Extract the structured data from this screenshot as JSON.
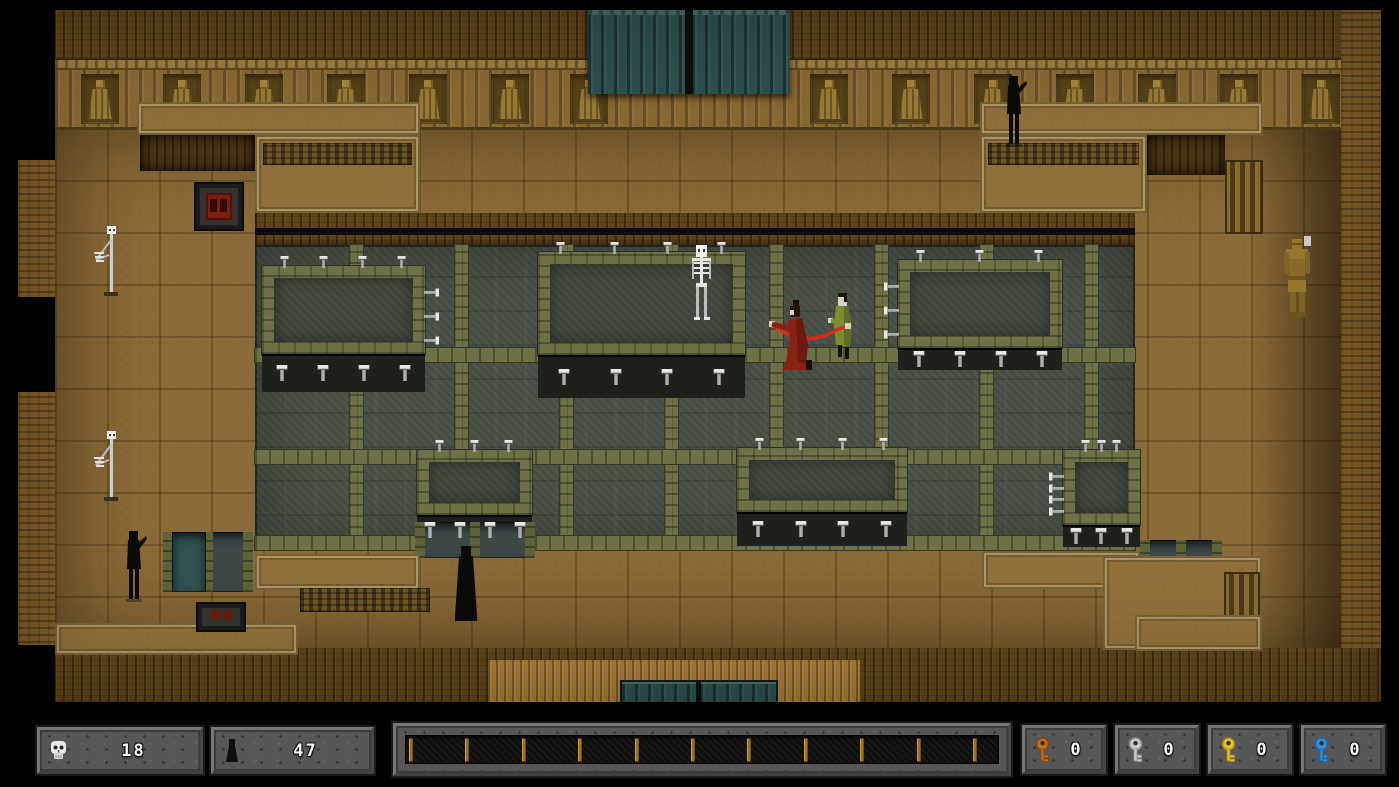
{
  "hud": {
    "skull_counter": {
      "icon": "skull-icon",
      "value": "18"
    },
    "figure_counter": {
      "icon": "figure-icon",
      "value": "47"
    },
    "progress_bar": {
      "tick_count": 11,
      "tick_color": "#9a7420"
    },
    "keys": [
      {
        "name": "orange-key",
        "value": "0",
        "color": "#c4701f",
        "color_dark": "#7e4610"
      },
      {
        "name": "silver-key",
        "value": "0",
        "color": "#cccccc",
        "color_dark": "#8f8f8f"
      },
      {
        "name": "gold-key",
        "value": "0",
        "color": "#e6be2e",
        "color_dark": "#a8861a"
      },
      {
        "name": "blue-key",
        "value": "0",
        "color": "#2f93dd",
        "color_dark": "#1b67a8"
      }
    ]
  },
  "map": {
    "colors": {
      "wood_dark": "#5e4319",
      "wood_mid": "#7a5a28",
      "floor": "#8b6b39",
      "pit": "#4c5248",
      "beam": "#6d7145",
      "door": "#2e5350",
      "whip": "#d92b18",
      "player_robe": "#8b2015",
      "player_robe_dark": "#6e1810",
      "enemy_robe": "#7d8c2e",
      "enemy_robe_dark": "#5f6d26",
      "bone": "#e6e6e6",
      "bone_dim": "#bdbdbd",
      "statue_gold": "#97782f",
      "statue_gold_dark": "#6e5520",
      "shadow_black": "#0b0b0a",
      "skin": "#d9d0c2"
    },
    "frieze_niches": [
      81,
      163,
      245,
      327,
      409,
      491,
      570,
      810,
      892,
      974,
      1056,
      1138,
      1220,
      1302
    ],
    "platforms": [
      {
        "x": 262,
        "y": 266,
        "w": 163,
        "h": 88,
        "shelf_h": 38,
        "top_spikes": 4,
        "shelf_spikes": 4,
        "side": "right",
        "side_spikes": 3
      },
      {
        "x": 538,
        "y": 252,
        "w": 207,
        "h": 103,
        "shelf_h": 43,
        "top_spikes": 4,
        "shelf_spikes": 4,
        "side": null,
        "side_spikes": 0
      },
      {
        "x": 898,
        "y": 260,
        "w": 164,
        "h": 88,
        "shelf_h": 22,
        "top_spikes": 3,
        "shelf_spikes": 4,
        "side": "left",
        "side_spikes": 3
      },
      {
        "x": 417,
        "y": 450,
        "w": 115,
        "h": 65,
        "shelf_h": 30,
        "top_spikes": 3,
        "shelf_spikes": 4,
        "side": null,
        "side_spikes": 0
      },
      {
        "x": 737,
        "y": 448,
        "w": 170,
        "h": 64,
        "shelf_h": 34,
        "top_spikes": 4,
        "shelf_spikes": 4,
        "side": null,
        "side_spikes": 0
      },
      {
        "x": 1063,
        "y": 450,
        "w": 77,
        "h": 75,
        "shelf_h": 22,
        "top_spikes": 3,
        "shelf_spikes": 3,
        "side": "left",
        "side_spikes": 4
      }
    ],
    "entities": [
      {
        "type": "skeleton-pole",
        "name": "skeleton-pole-top",
        "x": 90,
        "y": 226,
        "w": 38,
        "h": 72
      },
      {
        "type": "skeleton-pole",
        "name": "skeleton-pole-bottom",
        "x": 90,
        "y": 431,
        "w": 38,
        "h": 72
      },
      {
        "type": "skeleton",
        "name": "skeleton-enemy",
        "x": 686,
        "y": 245,
        "w": 30,
        "h": 76
      },
      {
        "type": "green-enemy",
        "name": "green-robed-enemy",
        "x": 828,
        "y": 293,
        "w": 30,
        "h": 68
      },
      {
        "type": "player-red",
        "name": "red-robed-player-with-whip",
        "x": 766,
        "y": 300,
        "w": 92,
        "h": 72
      },
      {
        "type": "shadow-figure",
        "name": "shadow-figure-top",
        "x": 1000,
        "y": 76,
        "w": 28,
        "h": 72
      },
      {
        "type": "shadow-figure",
        "name": "shadow-figure-left",
        "x": 120,
        "y": 531,
        "w": 28,
        "h": 72
      },
      {
        "type": "robed-figure",
        "name": "dark-robed-figure",
        "x": 450,
        "y": 546,
        "w": 32,
        "h": 80
      },
      {
        "type": "gold-statue",
        "name": "gold-statue",
        "x": 1280,
        "y": 236,
        "w": 34,
        "h": 84
      }
    ]
  }
}
